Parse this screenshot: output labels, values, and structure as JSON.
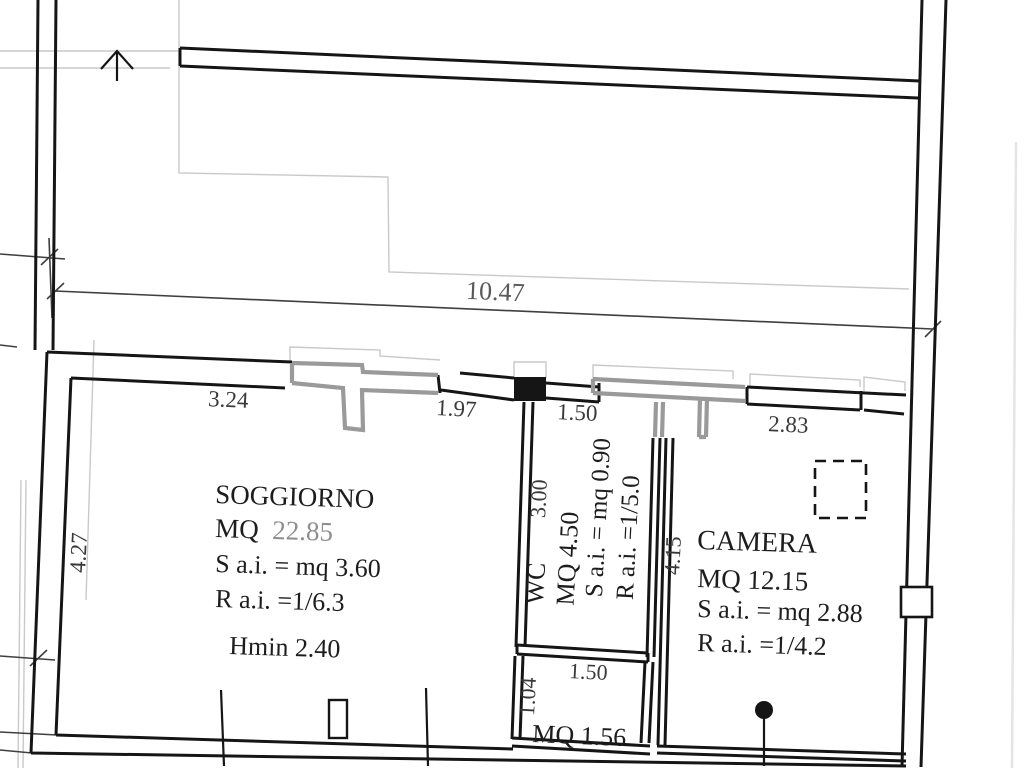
{
  "plan": {
    "rooms": {
      "soggiorno": {
        "name": "SOGGIORNO",
        "area_prefix": "MQ",
        "area_value": "22.85",
        "aeroilluminating_surface": "S a.i. = mq 3.60",
        "aeroilluminating_ratio": "R a.i. =1/6.3",
        "min_height": "Hmin 2.40"
      },
      "wc": {
        "name": "WC",
        "area": "MQ 4.50",
        "aeroilluminating_surface": "S a.i. = mq 0.90",
        "aeroilluminating_ratio": "R a.i. =1/5.0"
      },
      "camera": {
        "name": "CAMERA",
        "area": "MQ 12.15",
        "aeroilluminating_surface": "S a.i. = mq 2.88",
        "aeroilluminating_ratio": "R a.i. =1/4.2"
      },
      "small_room": {
        "area": "MQ 1.56"
      }
    },
    "dimensions": {
      "overall_width": "10.47",
      "soggiorno_width_left": "3.24",
      "soggiorno_width_right": "1.97",
      "soggiorno_depth": "4.27",
      "wc_width": "1.50",
      "wc_depth": "3.00",
      "camera_width": "2.83",
      "camera_depth": "4.15",
      "small_room_width": "1.50",
      "small_room_depth": "1.04"
    }
  }
}
